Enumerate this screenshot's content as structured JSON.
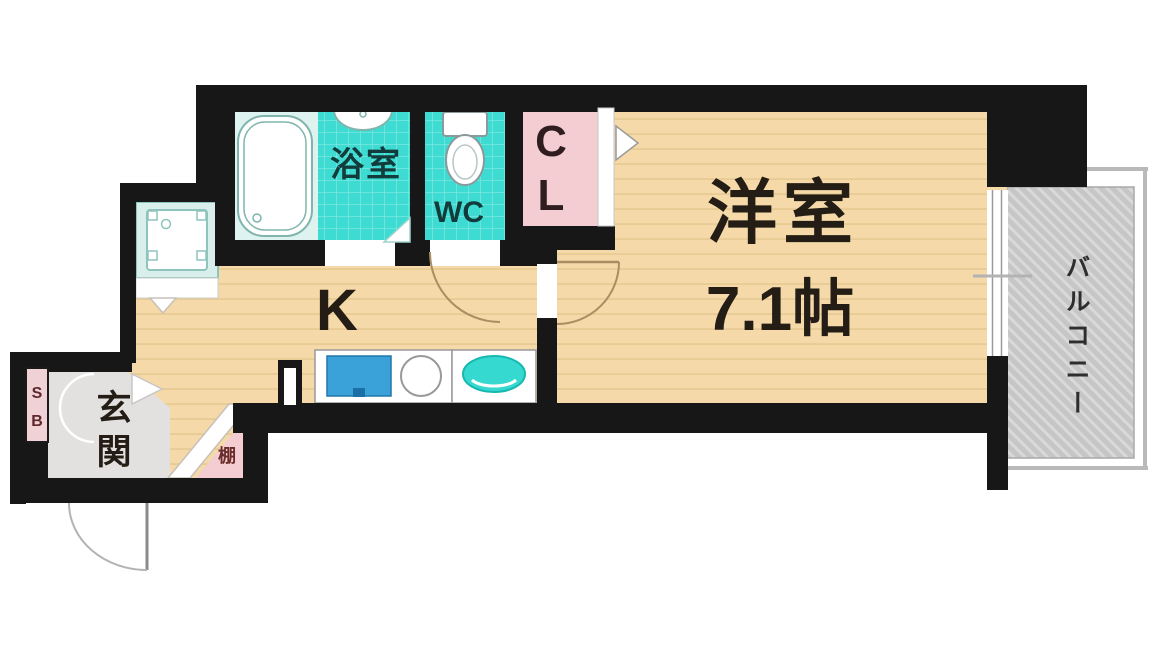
{
  "rooms": {
    "bathroom": {
      "label": "浴室"
    },
    "toilet": {
      "label": "WC"
    },
    "closet": {
      "chars": [
        "C",
        "L"
      ]
    },
    "kitchen": {
      "label": "K"
    },
    "western_room": {
      "label": "洋室",
      "size": "7.1帖"
    },
    "entrance": {
      "chars": [
        "玄",
        "関"
      ]
    },
    "shoe_box": {
      "chars": [
        "S",
        "B"
      ]
    },
    "shelf": {
      "label": "棚"
    },
    "balcony": {
      "label": "バルコニー"
    }
  },
  "colors": {
    "wall": "#171717",
    "wood_floor": "#f5d9a8",
    "wood_line": "#e8cb94",
    "tile_turquoise": "#3edbd3",
    "pale_tile": "#def2ef",
    "closet_pink": "#f3cdd1",
    "entrance_gray": "#e3e1e0",
    "balcony_gray": "#c6c6c6",
    "sink_blue": "#3ba2d9",
    "basin_teal": "#35d9d0",
    "teal_text": "#123c3c"
  }
}
